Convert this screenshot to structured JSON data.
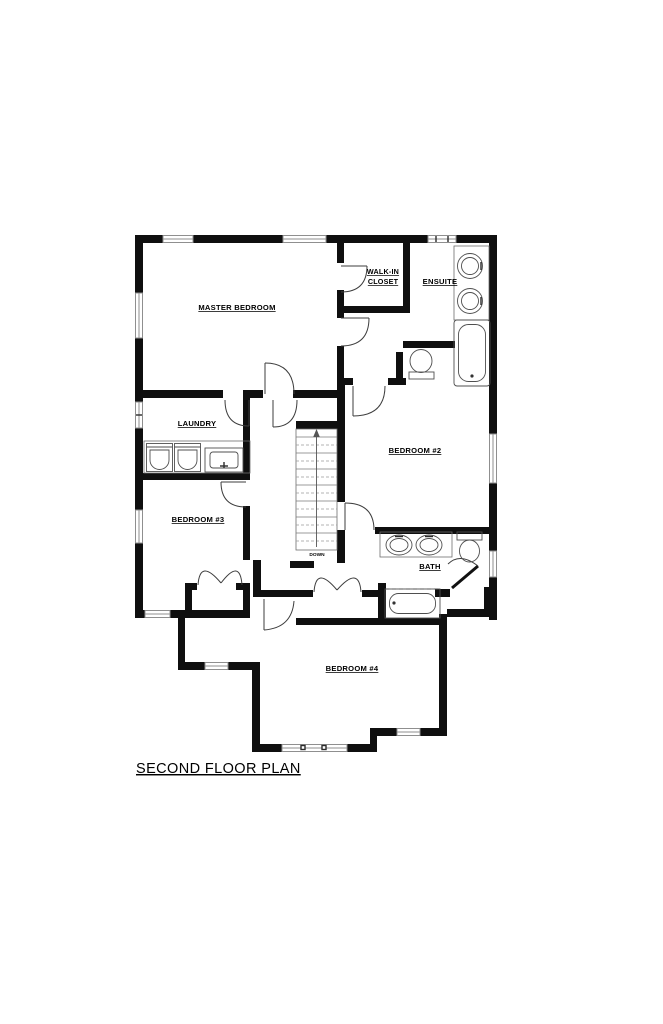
{
  "title": "SECOND FLOOR PLAN",
  "rooms": {
    "master_bedroom": "MASTER BEDROOM",
    "walk_in_closet_line1": "WALK-IN",
    "walk_in_closet_line2": "CLOSET",
    "ensuite": "ENSUITE",
    "bedroom_2": "BEDROOM #2",
    "laundry": "LAUNDRY",
    "bedroom_3": "BEDROOM #3",
    "bath": "BATH",
    "bedroom_4": "BEDROOM #4"
  },
  "stairs": {
    "direction_label": "DOWN"
  },
  "colors": {
    "wall": "#0f0f0f",
    "fixture_line": "#4f4f4f",
    "window_frame": "#8f8f8f",
    "text": "#000000",
    "background": "#ffffff"
  }
}
